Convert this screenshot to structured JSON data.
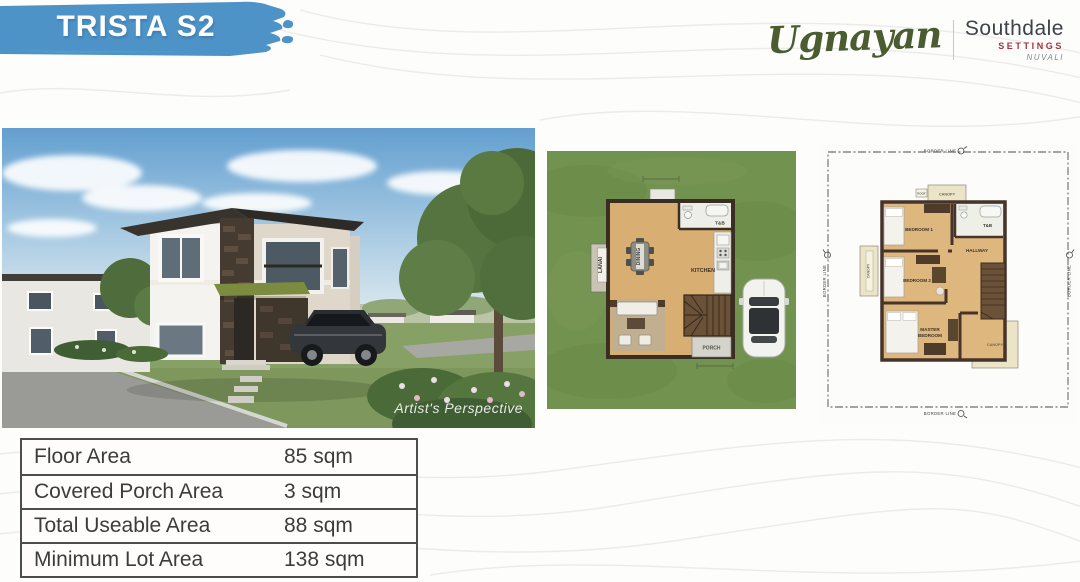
{
  "slide": {
    "title": "TRISTA S2",
    "logo": {
      "script_name": "Ugnayan",
      "development": "Southdale",
      "settings": "SETTINGS",
      "location": "NUVALI"
    }
  },
  "photo": {
    "caption": "Artist's Perspective"
  },
  "ground_plan": {
    "lanai": "LANAI",
    "dining": "DINING",
    "tnb": "T&B",
    "kitchen": "KITCHEN",
    "porch": "PORCH"
  },
  "second_plan": {
    "border_line": "BORDER LINE",
    "roof": "ROOF",
    "canopy": "CANOPY",
    "bedroom1": "BEDROOM 1",
    "tnb": "T&B",
    "hallway": "HALLWAY",
    "bedroom2": "BEDROOM 2",
    "master_1": "MASTER",
    "master_2": "BEDROOM"
  },
  "specs": {
    "rows": [
      {
        "label": "Floor Area",
        "value": "85 sqm"
      },
      {
        "label": "Covered Porch Area",
        "value": "3 sqm"
      },
      {
        "label": "Total Useable Area",
        "value": "88 sqm"
      },
      {
        "label": "Minimum Lot Area",
        "value": "138 sqm"
      }
    ]
  },
  "colors": {
    "banner_blue": "#4d93c7",
    "logo_green": "#4a5c30",
    "settings_red": "#a2343f",
    "grass_green": "#72924f",
    "wood_floor": "#d9ae72",
    "wall_brown": "#46342a",
    "canopy_beige": "#ece4c6",
    "table_border": "#4d4d4d",
    "text_dark": "#3c3c3c"
  }
}
